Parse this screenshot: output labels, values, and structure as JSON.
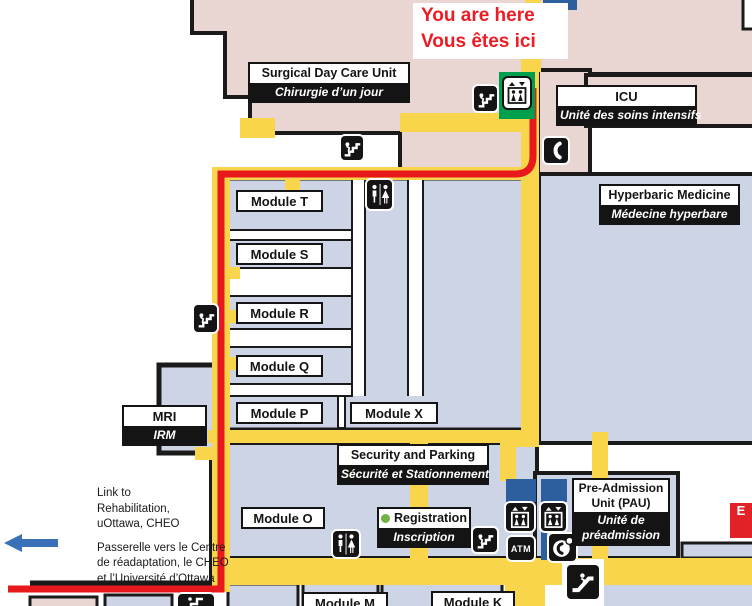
{
  "marker": {
    "en": "You are here",
    "fr": "Vous êtes ici"
  },
  "rooms": {
    "surgical": {
      "en": "Surgical Day Care Unit",
      "fr": "Chirurgie d’un jour"
    },
    "icu": {
      "en": "ICU",
      "fr": "Unité des soins intensifs"
    },
    "hyperbaric": {
      "en": "Hyperbaric Medicine",
      "fr": "Médecine hyperbare"
    },
    "mri": {
      "en": "MRI",
      "fr": "IRM"
    },
    "security": {
      "en": "Security and Parking",
      "fr": "Sécurité et Stationnement"
    },
    "registration": {
      "en": "Registration",
      "fr": "Inscription"
    },
    "pau": {
      "en1": "Pre-Admission",
      "en2": "Unit (PAU)",
      "fr1": "Unité de",
      "fr2": "préadmission"
    }
  },
  "modules": {
    "t": "Module T",
    "s": "Module S",
    "r": "Module R",
    "q": "Module Q",
    "p": "Module P",
    "x": "Module X",
    "o": "Module O",
    "m": "Module M",
    "k": "Module K"
  },
  "link_note": {
    "en1": "Link to",
    "en2": "Rehabilitation,",
    "en3": "uOttawa, CHEO",
    "fr1": "Passerelle vers le Centre",
    "fr2": "de réadaptation, le CHEO",
    "fr3": "et l’Université d’Ottawa"
  },
  "entrance": {
    "label": "E"
  },
  "icons": {
    "atm_label": "ATM"
  },
  "colors": {
    "route_red": "#e8191d",
    "corridor_yellow": "#f9d54b",
    "building_pink": "#e9d6d3",
    "building_blue": "#ccd4e6",
    "elevator_green": "#009f4d",
    "shaft_blue": "#2d5f9e",
    "marker_text_red": "#ed1c24",
    "entrance_red": "#e32228",
    "registration_dot_green": "#70b244",
    "link_arrow_blue": "#3a70b7"
  }
}
